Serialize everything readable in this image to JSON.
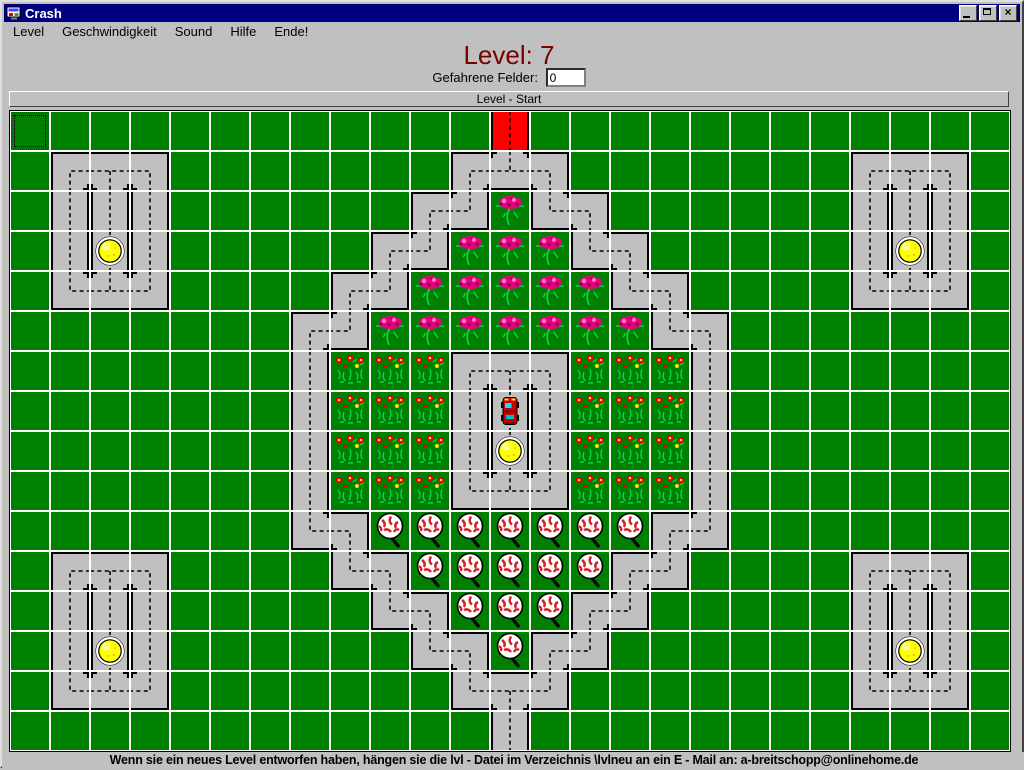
{
  "window": {
    "title": "Crash",
    "buttons": [
      "minimize",
      "maximize",
      "close"
    ]
  },
  "menu": {
    "items": [
      "Level",
      "Geschwindigkeit",
      "Sound",
      "Hilfe",
      "Ende!"
    ]
  },
  "hud": {
    "level_label": "Level: 7",
    "fields_label": "Gefahrene Felder:",
    "fields_value": "0",
    "board_header": "Level - Start"
  },
  "status_bar": {
    "text": "Wenn sie ein neues Level entworfen haben, hängen sie die lvl - Datei im Verzeichnis \\lvlneu an ein E - Mail an: a-breitschopp@onlinehome.de"
  },
  "colors": {
    "titlebar": "#000080",
    "chrome": "#c0c0c0",
    "grass": "#008000",
    "road": "#c0c0c0",
    "start_tile": "#ff0000",
    "level_title": "#7b0000",
    "grid_gap": "#ffffff",
    "ball": "#ffff00",
    "car": "#cc0000",
    "rose": "#e80080"
  },
  "board": {
    "cols": 25,
    "rows": 16,
    "cell_px": 38,
    "pitch_px": 40,
    "legend": {
      ".": "grass",
      "O": "grass with focus rectangle",
      "R": "red start road (vertical)",
      "|": "gray road vertical",
      "1": "road corner open south+east",
      "2": "road corner open south+west",
      "3": "road corner open north+east",
      "4": "road corner open north+west",
      "T": "road tee open south+east+west",
      "U": "road tee open north+east+west",
      "r": "rose flower",
      "p": "small flower patch",
      "t": "tree"
    },
    "grid": [
      "O...........R............",
      ".1T2.......1U2.......1T2.",
      ".|||......14r32......|||.",
      ".|||.....14rrr32.....|||.",
      ".3U4....14rrrrr32....3U4.",
      ".......14rrrrrrr32.......",
      ".......|ppp1T2ppp|.......",
      ".......|ppp|||ppp|.......",
      ".......|ppp|||ppp|.......",
      ".......|ppp3U4ppp|.......",
      ".......32ttttttt14.......",
      ".1T2....32ttttt14....1T2.",
      ".|||.....32ttt14.....|||.",
      ".|||......32t14......|||.",
      ".3U4.......3T4.......3U4.",
      "............|............"
    ],
    "balls": [
      [
        2,
        3
      ],
      [
        22,
        3
      ],
      [
        12,
        8
      ],
      [
        2,
        13
      ],
      [
        22,
        13
      ]
    ],
    "car": [
      12,
      7
    ]
  }
}
